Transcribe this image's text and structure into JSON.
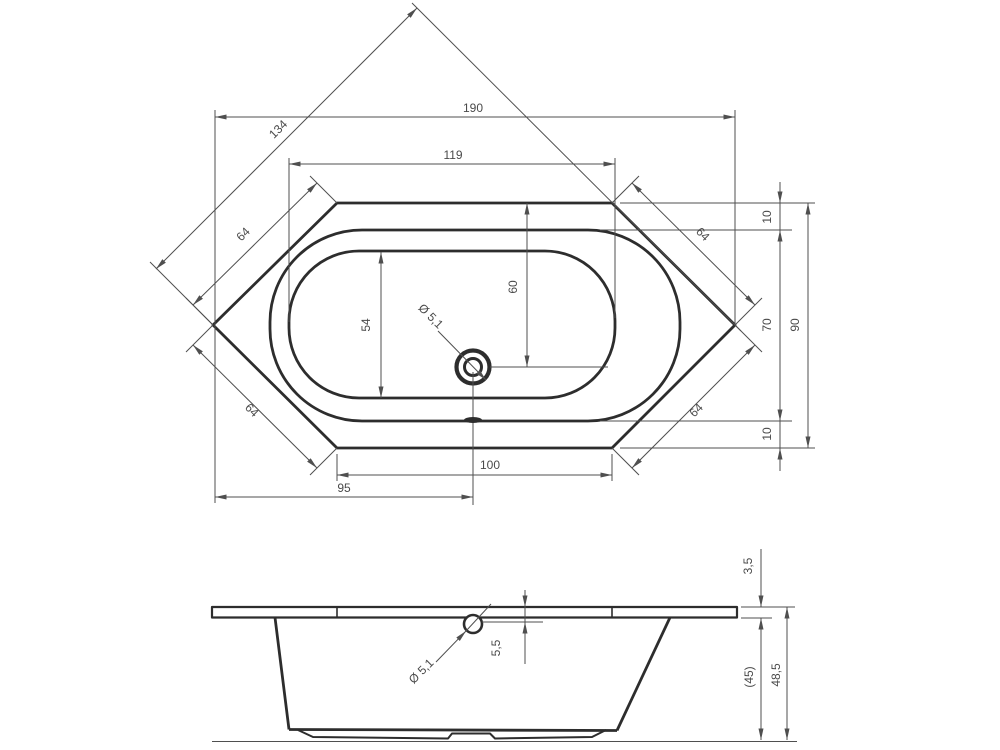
{
  "drawing_type": "bathtub technical drawing, hexagonal tub, top view and side view",
  "colors": {
    "outline": "#2d2d2d",
    "dimension_lines": "#4f4f4f",
    "background": "#ffffff"
  },
  "top_view": {
    "overall_length": "190",
    "diagonal_width": "134",
    "basin_length": "119",
    "corner_edge_top_left": "64",
    "corner_edge_top_right": "64",
    "corner_edge_bottom_left": "64",
    "corner_edge_bottom_right": "64",
    "rim_inset_top": "10",
    "rim_inner_width": "70",
    "overall_width": "90",
    "rim_inset_bottom": "10",
    "drain_from_top_edge": "60",
    "basin_width": "54",
    "drain_diameter": "Ø 5,1",
    "bottom_edge_length": "100",
    "drain_from_left": "95"
  },
  "side_view": {
    "rim_thickness": "3,5",
    "drain_below_rim": "5,5",
    "drain_diameter": "Ø 5,1",
    "body_height": "(45)",
    "total_height": "48,5"
  }
}
